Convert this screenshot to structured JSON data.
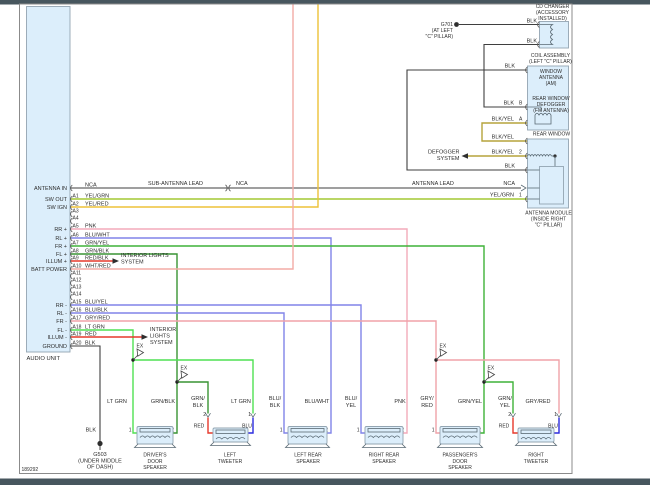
{
  "diagram_number": "189292",
  "splice_label": "EX",
  "audio_unit": {
    "label": "AUDIO UNIT",
    "rows": [
      {
        "pin": "",
        "fn": "ANTENNA IN",
        "wire": "NCA"
      },
      {
        "pin": "A1",
        "fn": "SW OUT",
        "wire": "YEL/GRN"
      },
      {
        "pin": "A2",
        "fn": "SW IGN",
        "wire": "YEL/RED"
      },
      {
        "pin": "A3",
        "fn": "",
        "wire": ""
      },
      {
        "pin": "A4",
        "fn": "",
        "wire": ""
      },
      {
        "pin": "A5",
        "fn": "RR +",
        "wire": "PNK"
      },
      {
        "pin": "A6",
        "fn": "RL +",
        "wire": "BLU/WHT"
      },
      {
        "pin": "A7",
        "fn": "FR +",
        "wire": "GRN/YEL"
      },
      {
        "pin": "A8",
        "fn": "FL +",
        "wire": "GRN/BLK"
      },
      {
        "pin": "A9",
        "fn": "ILLUM +",
        "wire": "RED/BLK"
      },
      {
        "pin": "A10",
        "fn": "BATT POWER",
        "wire": "WHT/RED"
      },
      {
        "pin": "A11",
        "fn": "",
        "wire": ""
      },
      {
        "pin": "A12",
        "fn": "",
        "wire": ""
      },
      {
        "pin": "A13",
        "fn": "",
        "wire": ""
      },
      {
        "pin": "A14",
        "fn": "",
        "wire": ""
      },
      {
        "pin": "A15",
        "fn": "RR -",
        "wire": "BLU/YEL"
      },
      {
        "pin": "A16",
        "fn": "RL -",
        "wire": "BLU/BLK"
      },
      {
        "pin": "A17",
        "fn": "FR -",
        "wire": "GRY/RED"
      },
      {
        "pin": "A18",
        "fn": "FL -",
        "wire": "LT GRN"
      },
      {
        "pin": "A19",
        "fn": "ILLUM -",
        "wire": "RED"
      },
      {
        "pin": "A20",
        "fn": "GROUND",
        "wire": "BLK"
      }
    ]
  },
  "antenna_line": {
    "sub_lead": "SUB-ANTENNA LEAD",
    "nca": "NCA",
    "lead": "ANTENNA LEAD"
  },
  "interior_lights_a": [
    "INTERIOR LIGHTS",
    "SYSTEM"
  ],
  "interior_lights_b": [
    "INTERIOR",
    "LIGHTS",
    "SYSTEM"
  ],
  "g503": {
    "wire": "BLK",
    "name": "G503",
    "loc": [
      "(UNDER MIDDLE",
      "OF DASH)"
    ]
  },
  "top_right": {
    "cd_changer": [
      "CD CHANGER",
      "(ACCESSORY",
      "INSTALLED)"
    ],
    "cd_wire_top": "BLK",
    "cd_wire_bottom": "BLK",
    "g701": [
      "G701",
      "(AT LEFT",
      "\"C\" PILLAR)"
    ],
    "coil_assembly": [
      "COIL ASSEMBLY",
      "(LEFT \"C\" PILLAR)"
    ],
    "window_antenna": [
      "WINDOW",
      "ANTENNA",
      "(AM)"
    ],
    "rear_defogger": [
      "REAR WINDOW",
      "DEFOGGER",
      "(FM ANTENNA)"
    ],
    "am_wire": "BLK",
    "pin_b": "B",
    "pin_b_wire": "BLK",
    "pin_a": "A",
    "pin_a_wire": "BLK/YEL",
    "link_wire": "BLK/YEL",
    "rear_window_label": "REAR WINDOW",
    "defogger_system": [
      "DEFOGGER",
      "SYSTEM"
    ],
    "pin2": "2",
    "pin2_wire": "BLK/YEL",
    "module_gnd_wire": "BLK",
    "module_nca": "NCA",
    "pin1": "1",
    "pin1_wire": "YEL/GRN",
    "antenna_module": [
      "ANTENNA MODULE",
      "(INSIDE RIGHT",
      "\"C\" PILLAR)"
    ]
  },
  "bottom_wire_labels": [
    [
      "LT GRN"
    ],
    [
      "GRN/BLK"
    ],
    [
      "GRN/",
      "BLK"
    ],
    [
      "LT GRN"
    ],
    [
      "BLU/",
      "BLK"
    ],
    [
      "BLU/WHT"
    ],
    [
      "BLU/",
      "YEL"
    ],
    [
      "PNK"
    ],
    [
      "GRY/",
      "RED"
    ],
    [
      "GRN/YEL"
    ],
    [
      "GRN/",
      "YEL"
    ],
    [
      "GRY/RED"
    ]
  ],
  "speakers": [
    {
      "name": [
        "DRIVER'S",
        "DOOR",
        "SPEAKER"
      ],
      "pin1": "1",
      "pin2": "2"
    },
    {
      "name": [
        "LEFT",
        "TWEETER"
      ],
      "pin1": "1",
      "pin2": "2",
      "wire_pin2": "RED",
      "wire_pin1": "BLU"
    },
    {
      "name": [
        "LEFT REAR",
        "SPEAKER"
      ],
      "pin1": "1",
      "pin2": "2"
    },
    {
      "name": [
        "RIGHT REAR",
        "SPEAKER"
      ],
      "pin1": "1",
      "pin2": "2"
    },
    {
      "name": [
        "PASSENGER'S",
        "DOOR",
        "SPEAKER"
      ],
      "pin1": "1",
      "pin2": "2"
    },
    {
      "name": [
        "RIGHT",
        "TWEETER"
      ],
      "pin1": "1",
      "pin2": "2",
      "wire_pin2": "RED",
      "wire_pin1": "BLU"
    }
  ],
  "colors": {
    "yel_grn": "#a4c934",
    "yel_red": "#edc238",
    "pnk": "#f3aaba",
    "blu": "#8084e8",
    "grn_yel": "#3fb238",
    "grn_blk": "#399434",
    "red": "#e6392c",
    "wht_red": "#f3aba6",
    "gry_red": "#f0a2a9",
    "lt_grn": "#4fe152",
    "blk_yel": "#b5a43c",
    "blu_solid": "#2b2bdf",
    "blk": "#3f3f3f",
    "box_fill": "#dceefb",
    "chrome": "#47565e"
  }
}
